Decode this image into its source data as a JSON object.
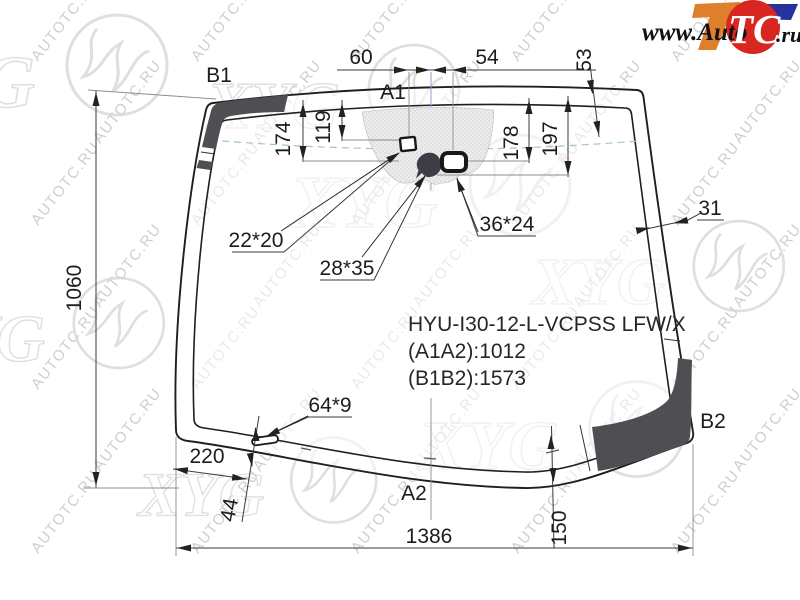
{
  "branding": {
    "www_auto": "www.Auto",
    "tc": "TC",
    "ru": ".ru"
  },
  "watermark": {
    "diagonal_text": "AUTOTC.RU",
    "xyg": "XYG"
  },
  "part": {
    "code": "HYU-I30-12-L-VCPSS LFW/X",
    "length_a": "(A1A2):1012",
    "length_b": "(B1B2):1573"
  },
  "labels": {
    "b1": "B1",
    "a1": "A1",
    "a2": "A2",
    "b2": "B2"
  },
  "dims": {
    "d60": "60",
    "d54": "54",
    "d53": "53",
    "d174": "174",
    "d119": "119",
    "d178": "178",
    "d197": "197",
    "d31": "31",
    "d1060": "1060",
    "d1386": "1386",
    "d150": "150",
    "d220": "220",
    "d44": "44",
    "mirror_mount": "22*20",
    "sensor_left": "28*35",
    "sensor_right": "36*24",
    "slot": "64*9"
  }
}
